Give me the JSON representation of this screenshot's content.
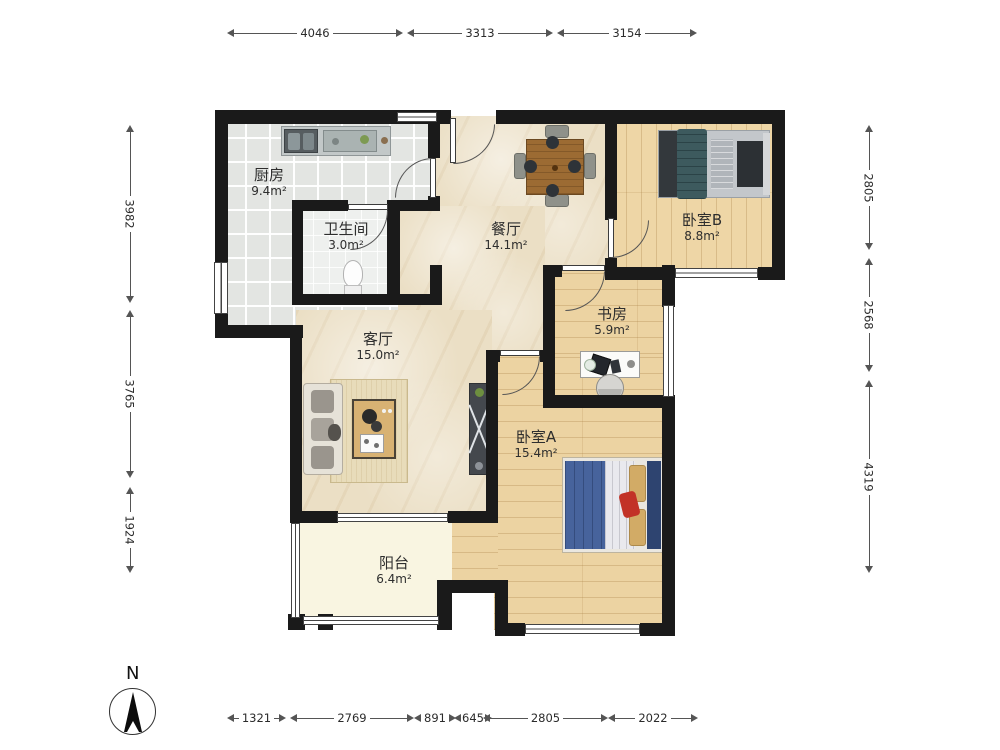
{
  "rooms": [
    {
      "id": "kitchen",
      "name": "厨房",
      "area": "9.4m²"
    },
    {
      "id": "bathroom",
      "name": "卫生间",
      "area": "3.0m²"
    },
    {
      "id": "dining",
      "name": "餐厅",
      "area": "14.1m²"
    },
    {
      "id": "bedroom_b",
      "name": "卧室B",
      "area": "8.8m²"
    },
    {
      "id": "study",
      "name": "书房",
      "area": "5.9m²"
    },
    {
      "id": "living",
      "name": "客厅",
      "area": "15.0m²"
    },
    {
      "id": "bedroom_a",
      "name": "卧室A",
      "area": "15.4m²"
    },
    {
      "id": "balcony",
      "name": "阳台",
      "area": "6.4m²"
    }
  ],
  "dimensions": {
    "top": [
      "4046",
      "3313",
      "3154"
    ],
    "left": [
      "3982",
      "3765",
      "1924"
    ],
    "right": [
      "2805",
      "2568",
      "4319"
    ],
    "bottom": [
      "1321",
      "2769",
      "891",
      "645",
      "2805",
      "2022"
    ]
  },
  "compass": {
    "label": "N"
  },
  "colors": {
    "wall": "#1a1a1a",
    "marble_floor": "#ebdfc5",
    "wood_floor": "#ecd3a2",
    "tile_floor": "#e3e5e2",
    "balcony_floor": "#f9f5e1",
    "bed_a_blanket": "#47639c",
    "bed_b_blanket": "#3d5a5e",
    "accent_red": "#c23227"
  }
}
